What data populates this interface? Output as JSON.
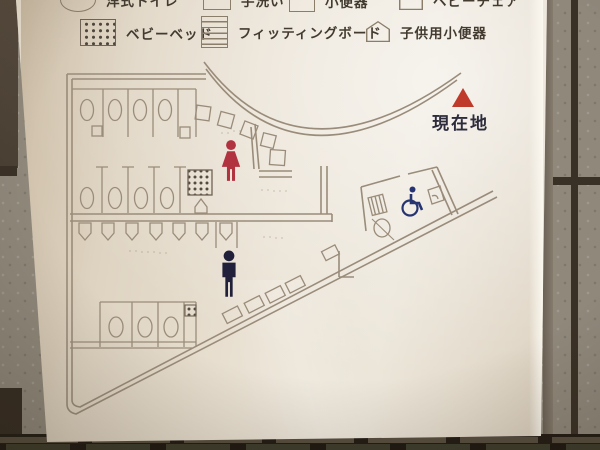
{
  "sign": {
    "type": "restroom-floor-map",
    "legend": {
      "row1": [
        {
          "icon": "western-toilet-oval-icon",
          "label": "洋式トイレ"
        },
        {
          "icon": "hand-wash-rect-icon",
          "label": "手洗い"
        },
        {
          "icon": "urinal-square-icon",
          "label": "小便器"
        },
        {
          "icon": "baby-chair-pentagon-icon",
          "label": "ベビーチェア"
        }
      ],
      "row2": [
        {
          "icon": "baby-bed-dotted-icon",
          "label": "ベビーベッド"
        },
        {
          "icon": "fitting-board-striped-icon",
          "label": "フィッティングボード"
        },
        {
          "icon": "child-urinal-pentagon-icon",
          "label": "子供用小便器"
        }
      ]
    },
    "marker": {
      "label": "現在地",
      "triangle_color": "#c03a2b",
      "text_color": "#2c2c3c"
    },
    "pictograms": {
      "female": {
        "color": "#b13340"
      },
      "male": {
        "color": "#20203a"
      },
      "wheelchair": {
        "color": "#273472"
      }
    },
    "map_line_color": "#9a8c7a"
  }
}
